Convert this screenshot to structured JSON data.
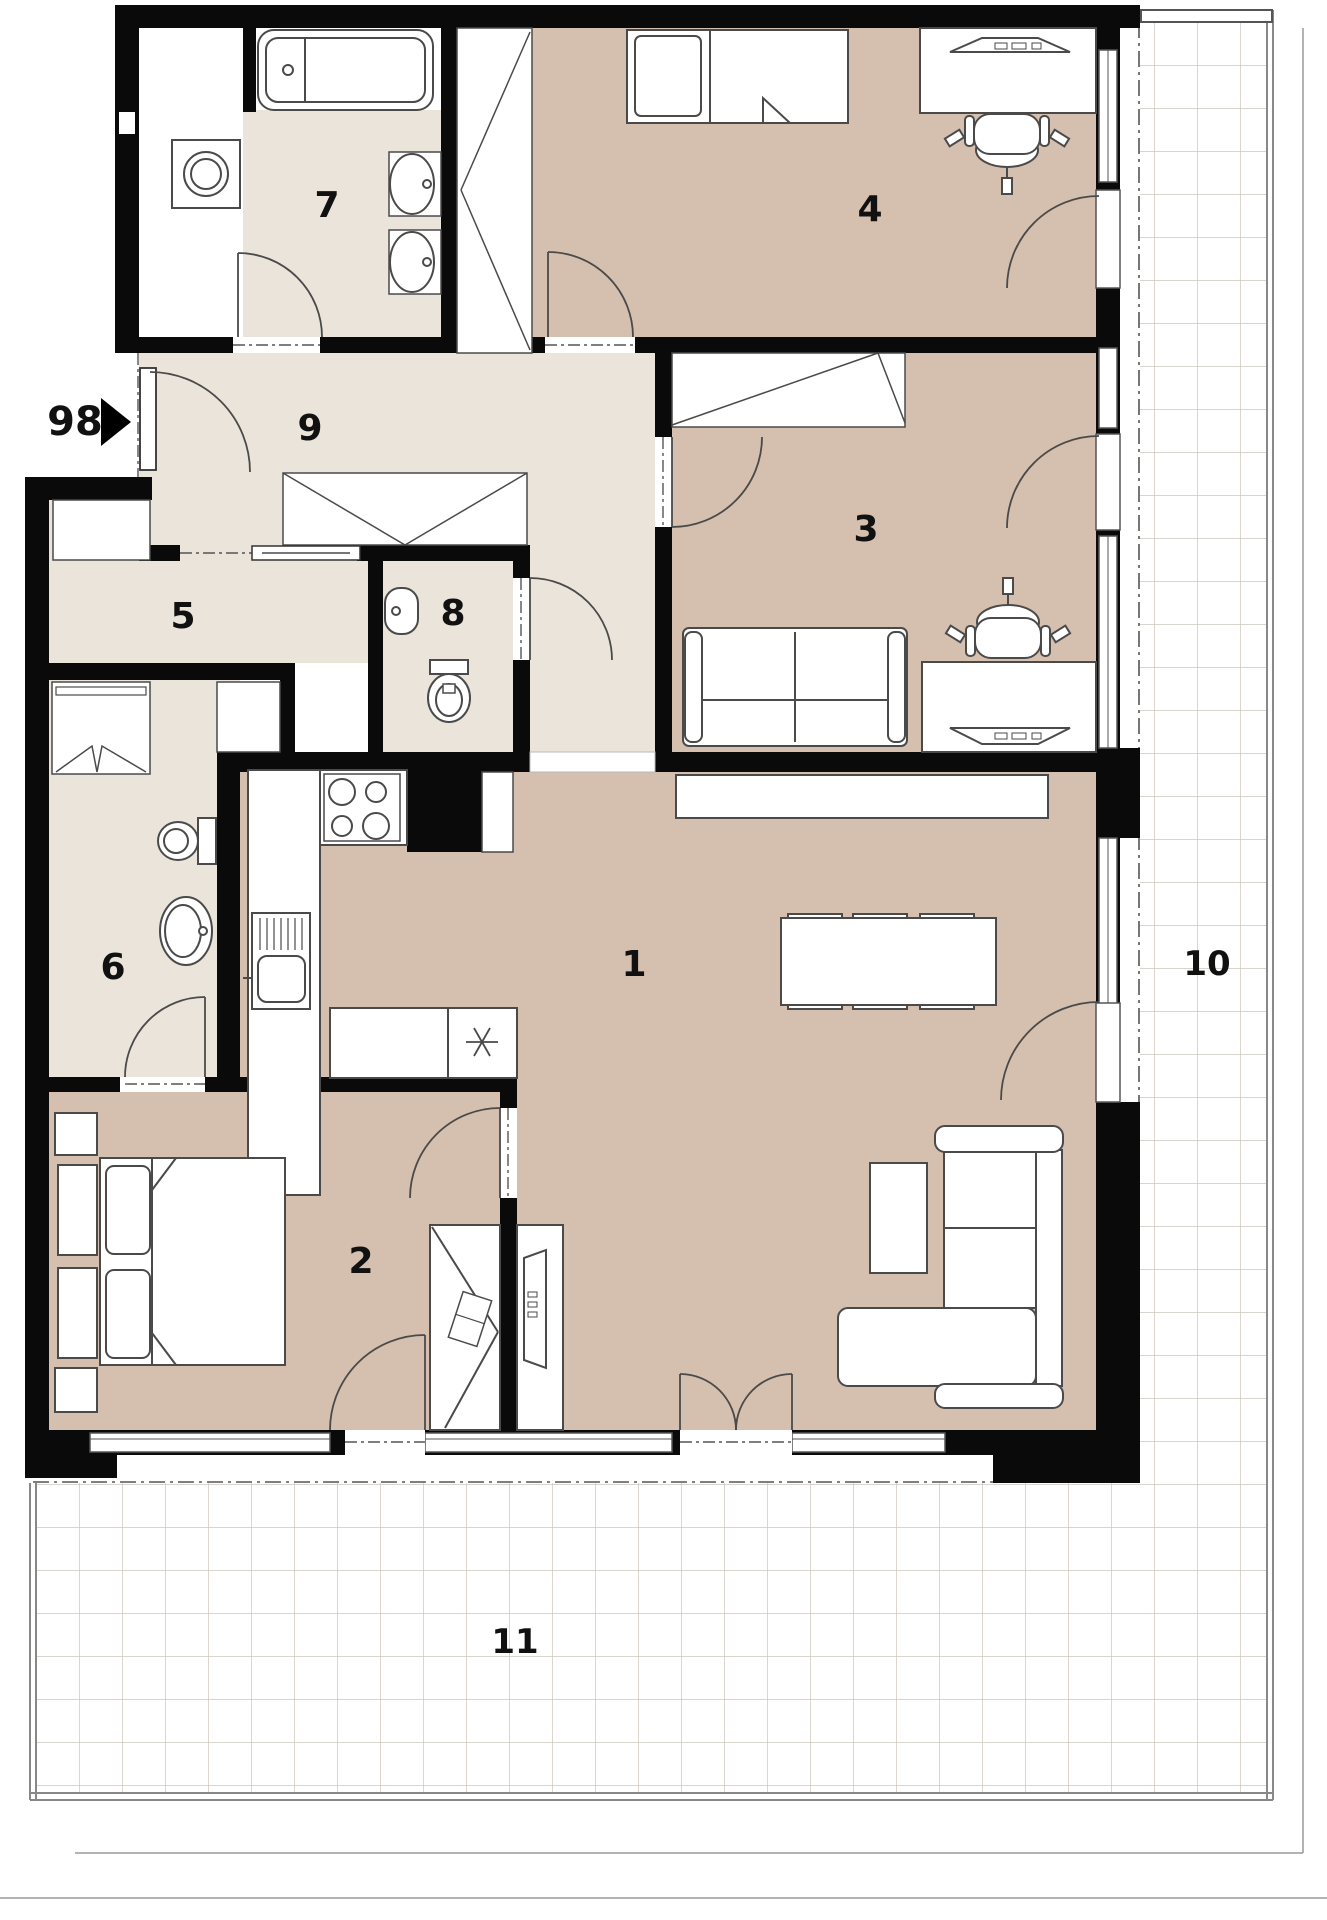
{
  "plan": {
    "type": "apartment-floor-plan",
    "palette": {
      "wall": "#0a0a0a",
      "room_warm": "#d5bfae",
      "room_light": "#eae4db",
      "fixture_fill": "#ffffff",
      "fixture_line": "#4a4a4a",
      "grid_line": "#ccc5bd",
      "railing_line": "#888888"
    },
    "rooms": {
      "r1": {
        "label": "1"
      },
      "r2": {
        "label": "2"
      },
      "r3": {
        "label": "3"
      },
      "r4": {
        "label": "4"
      },
      "r5": {
        "label": "5"
      },
      "r6": {
        "label": "6"
      },
      "r7": {
        "label": "7"
      },
      "r8": {
        "label": "8"
      },
      "r9": {
        "label": "9"
      },
      "r10": {
        "label": "10"
      },
      "r11": {
        "label": "11"
      }
    },
    "entrance": {
      "label": "98"
    }
  }
}
